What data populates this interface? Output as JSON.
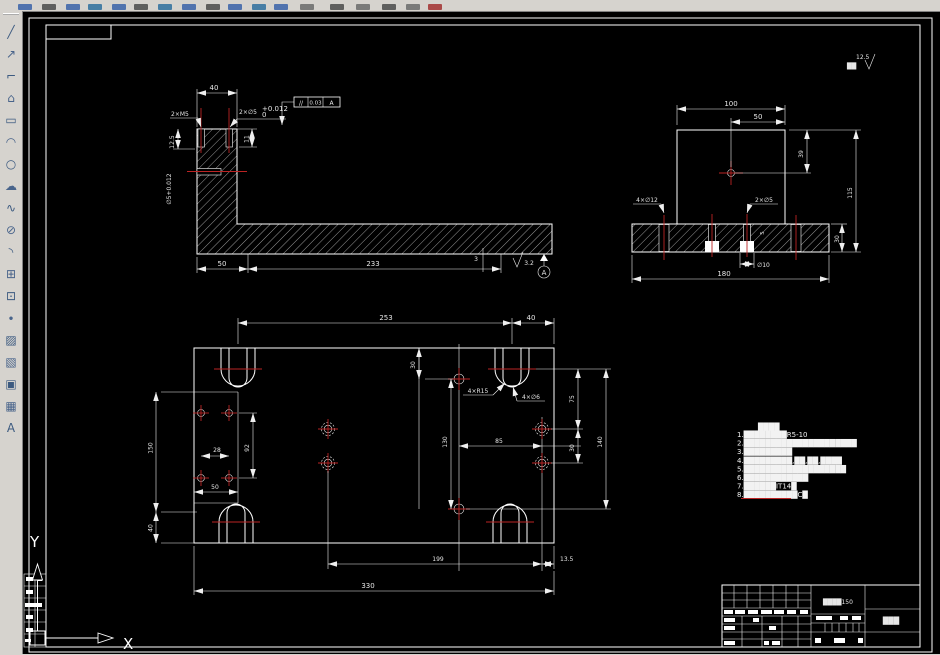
{
  "app": {
    "canvas_bg": "#000000",
    "ui_bg": "#d6d3ce",
    "line_color": "#ffffff",
    "centerline_color": "#bb2323"
  },
  "left_toolbar": {
    "icons": [
      {
        "name": "line",
        "glyph": "╱"
      },
      {
        "name": "construction-line",
        "glyph": "↗"
      },
      {
        "name": "polyline",
        "glyph": "⌐"
      },
      {
        "name": "polygon",
        "glyph": "⌂"
      },
      {
        "name": "rectangle",
        "glyph": "▭"
      },
      {
        "name": "arc",
        "glyph": "◠"
      },
      {
        "name": "circle",
        "glyph": "○"
      },
      {
        "name": "revision-cloud",
        "glyph": "☁"
      },
      {
        "name": "spline",
        "glyph": "∿"
      },
      {
        "name": "ellipse",
        "glyph": "⊘"
      },
      {
        "name": "ellipse-arc",
        "glyph": "◝"
      },
      {
        "name": "insert-block",
        "glyph": "⊞"
      },
      {
        "name": "make-block",
        "glyph": "⊡"
      },
      {
        "name": "point",
        "glyph": "∙"
      },
      {
        "name": "hatch",
        "glyph": "▨"
      },
      {
        "name": "gradient",
        "glyph": "▧"
      },
      {
        "name": "region",
        "glyph": "▣"
      },
      {
        "name": "table",
        "glyph": "▦"
      },
      {
        "name": "multiline-text",
        "glyph": "A"
      }
    ]
  },
  "surface_note": {
    "rest": "██",
    "value": "12.5"
  },
  "views": {
    "front": {
      "width_top": "40",
      "thread_label": "2×M5",
      "hole_label": "2×∅5",
      "hole_tol_sup": "+0.012",
      "hole_tol_sub": "0",
      "fcf_sym": "//",
      "fcf_val": "0.03",
      "fcf_datum": "A",
      "depth1": "12.5",
      "depth2": "11",
      "side_hole": "∅5+0.012",
      "seg1": "50",
      "seg2": "233",
      "step": "3",
      "roughness": "3.2",
      "datum": "A"
    },
    "side": {
      "w100": "100",
      "w50": "50",
      "h39": "39",
      "h115": "115",
      "h30": "30",
      "w180": "180",
      "cbore": "∅10",
      "cbore_d": "5",
      "holes_small": "2×∅5",
      "holes_big": "4×∅12"
    },
    "plan": {
      "top1": "253",
      "top2": "40",
      "left1": "150",
      "left2": "40",
      "p28": "28",
      "p92": "92",
      "p50": "50",
      "r15": "4×R15",
      "d6": "4×∅6",
      "t30": "30",
      "r130": "130",
      "r85": "85",
      "r75": "75",
      "r30": "30",
      "r140": "140",
      "b199": "199",
      "b135": "13.5",
      "b330": "330"
    }
  },
  "notes": {
    "title": "████",
    "items": [
      "1.████████R5-10",
      "2.█████████████████████",
      "3.█████████",
      "4.█████████,██,██,████",
      "5.███████████████████",
      "6.████████████",
      "7.██████IT14█",
      "8.██████████C█"
    ]
  },
  "title_block": {
    "material": "████150",
    "part_name": "███"
  },
  "ucs": {
    "x": "X",
    "y": "Y"
  }
}
